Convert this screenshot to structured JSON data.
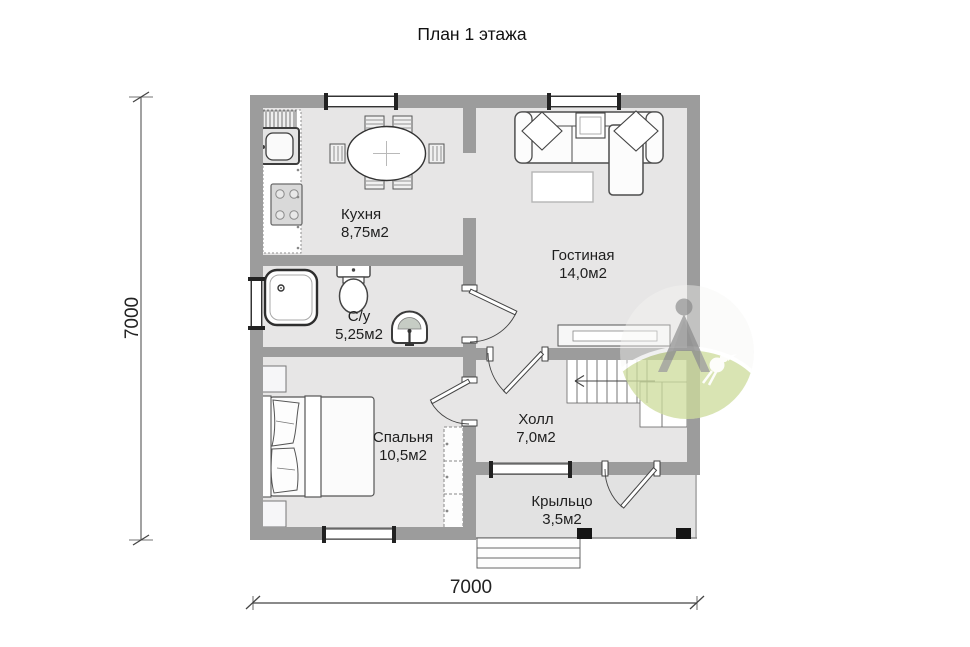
{
  "title": "План 1 этажа",
  "rooms": {
    "kitchen": {
      "name": "Кухня",
      "area": "8,75м2"
    },
    "living_room": {
      "name": "Гостиная",
      "area": "14,0м2"
    },
    "bathroom": {
      "name": "С/у",
      "area": "5,25м2"
    },
    "bedroom": {
      "name": "Спальня",
      "area": "10,5м2"
    },
    "hall": {
      "name": "Холл",
      "area": "7,0м2"
    },
    "porch": {
      "name": "Крыльцо",
      "area": "3,5м2"
    }
  },
  "dimensions": {
    "left": "7000",
    "bottom": "7000"
  },
  "colors": {
    "wall": "#9c9c9c",
    "floor": "#e7e6e6",
    "porch_floor": "#e2e2e2",
    "post": "#151515",
    "watermark_green": "#c9da92"
  },
  "furniture_icons": [
    "kitchen-counter-icon",
    "sink-icon",
    "stove-icon",
    "dining-table-icon",
    "chair-icon",
    "sofa-icon",
    "pillow-icon",
    "coffee-table-icon",
    "tv-stand-icon",
    "shower-icon",
    "toilet-icon",
    "washbasin-icon",
    "bed-icon",
    "nightstand-icon",
    "wardrobe-icon",
    "stairs-icon",
    "entry-steps-icon",
    "watermark-logo"
  ]
}
